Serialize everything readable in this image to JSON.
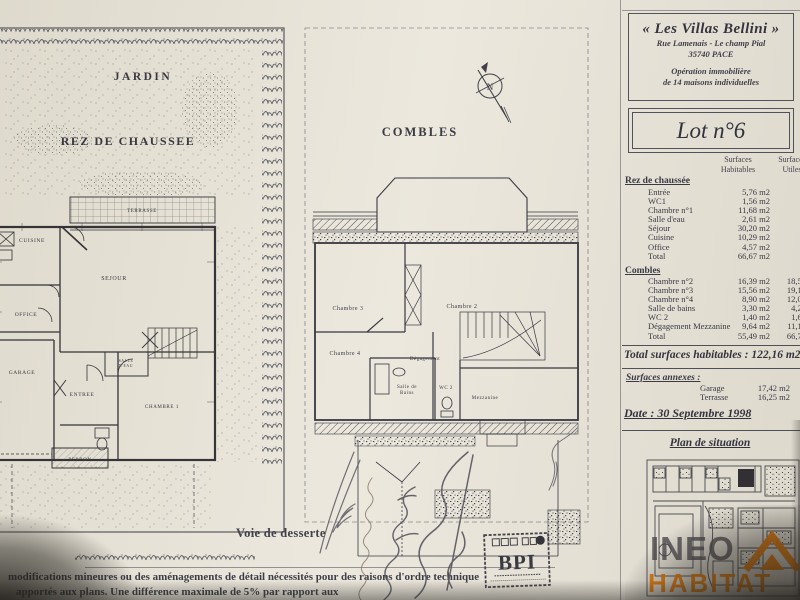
{
  "header": {
    "title": "« Les Villas Bellini »",
    "address1": "Rue Lamenais - Le champ Pial",
    "address2": "35740 PACE",
    "op1": "Opération immobilière",
    "op2": "de 14 maisons individuelles"
  },
  "lot": {
    "label": "Lot n°6"
  },
  "table": {
    "col_hab_1": "Surfaces",
    "col_hab_2": "Habitables",
    "col_util_1": "Surfaces",
    "col_util_2": "Utiles",
    "rdc_title": "Rez de chaussée",
    "rdc_rows": [
      {
        "label": "Entrée",
        "hab": "5,76 m2"
      },
      {
        "label": "WC1",
        "hab": "1,56 m2"
      },
      {
        "label": "Chambre n°1",
        "hab": "11,68 m2"
      },
      {
        "label": "Salle d'eau",
        "hab": "2,61 m2"
      },
      {
        "label": "Séjour",
        "hab": "30,20 m2"
      },
      {
        "label": "Cuisine",
        "hab": "10,29 m2"
      },
      {
        "label": "Office",
        "hab": "4,57 m2"
      },
      {
        "label": "Total",
        "hab": "66,67 m2"
      }
    ],
    "combles_title": "Combles",
    "combles_rows": [
      {
        "label": "Chambre n°2",
        "hab": "16,39 m2",
        "util": "18,56"
      },
      {
        "label": "Chambre n°3",
        "hab": "15,56 m2",
        "util": "19,10"
      },
      {
        "label": "Chambre n°4",
        "hab": "8,90 m2",
        "util": "12,07"
      },
      {
        "label": "Salle de bains",
        "hab": "3,30 m2",
        "util": "4,22"
      },
      {
        "label": "WC 2",
        "hab": "1,40 m2",
        "util": "1,62"
      },
      {
        "label": "Dégagement Mezzanine",
        "hab": "9,64 m2",
        "util": "11,13"
      },
      {
        "label": "Total",
        "hab": "55,49 m2",
        "util": "66,70"
      }
    ],
    "total_line": "Total surfaces habitables : 122,16 m2",
    "annexes_title": "Surfaces annexes :",
    "annexes_rows": [
      {
        "label": "Garage",
        "value": "17,42 m2"
      },
      {
        "label": "Terrasse",
        "value": "16,25 m2"
      }
    ],
    "date_line": "Date : 30 Septembre 1998"
  },
  "situation": {
    "title": "Plan de situation"
  },
  "plan_rdc": {
    "jardin": "JARDIN",
    "title": "REZ DE CHAUSSEE",
    "rooms": {
      "terrasse": "TERRASSE",
      "cuisine": "CUISINE",
      "sejour": "SEJOUR",
      "office": "OFFICE",
      "garage": "GARAGE",
      "entree": "ENTREE",
      "salle_eau_1": "SALLE",
      "salle_eau_2": "D'EAU",
      "chambre1": "CHAMBRE 1",
      "perron": "PERRON"
    }
  },
  "plan_combles": {
    "title": "COMBLES",
    "north": "N",
    "rooms": {
      "chambre3": "Chambre 3",
      "chambre2": "Chambre 2",
      "chambre4": "Chambre 4",
      "degagement": "Dégagement",
      "salle_bains_1": "Salle de",
      "salle_bains_2": "Bains",
      "wc2": "WC 2",
      "mezzanine": "Mezzanine"
    }
  },
  "bottom": {
    "voie": "Voie de desserte",
    "note1": "modifications mineures ou des aménagements de détail nécessités pour des raisons d'ordre technique",
    "note2": "apportés aux plans. Une différence maximale de 5% par rapport aux"
  },
  "stamp": {
    "text": "BPI"
  },
  "watermark": {
    "line1": "INEO",
    "line2": "HABITAT"
  },
  "colors": {
    "accent_orange": "#f07c00",
    "ink": "#33333f",
    "paper": "#e9e5da"
  }
}
